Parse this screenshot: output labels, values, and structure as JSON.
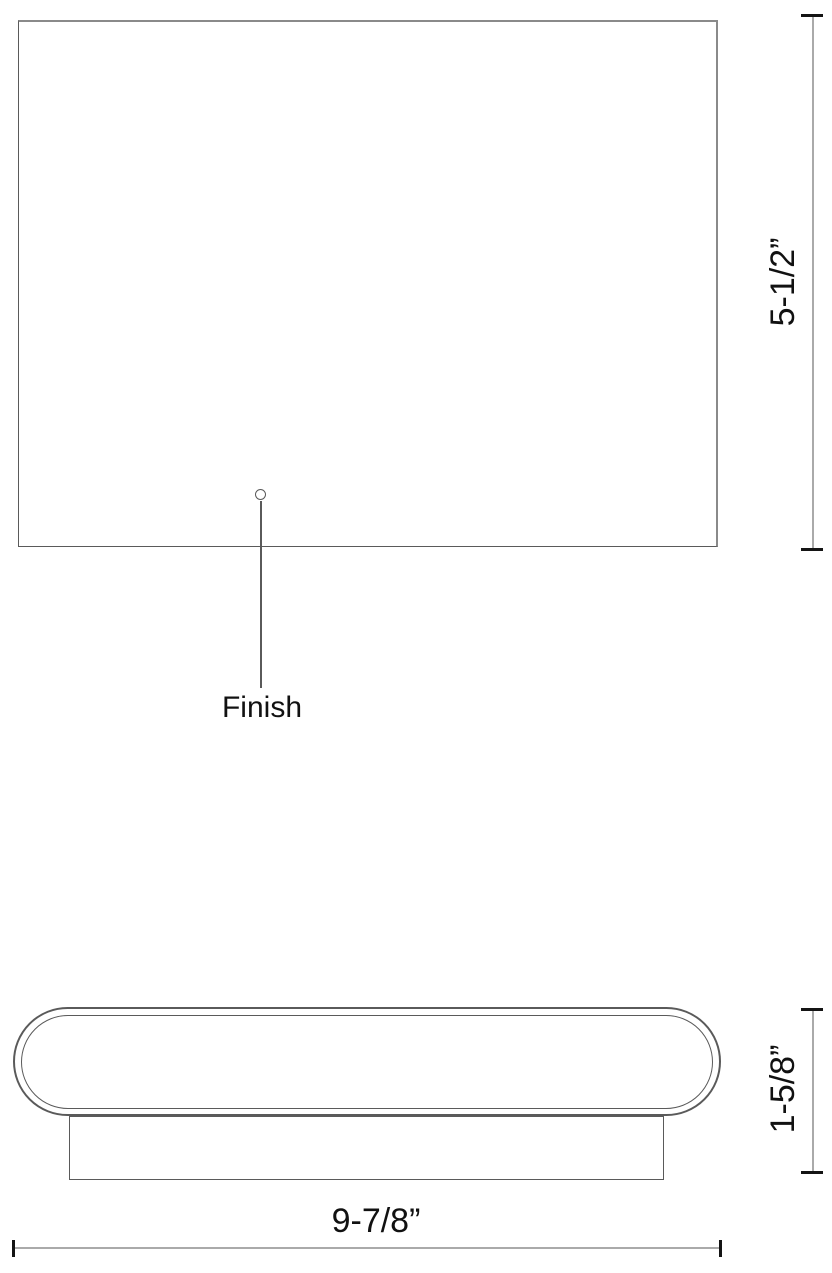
{
  "colors": {
    "background": "#ffffff",
    "outline": "#5a5a5a",
    "outline_soft": "#8a8a8a",
    "dimension_line": "#aaaaaa",
    "tick": "#141414",
    "text": "#111111"
  },
  "front_view": {
    "height_dimension_label": "5-1/2”",
    "finish_callout_label": "Finish"
  },
  "bottom_view": {
    "depth_dimension_label": "1-5/8”",
    "width_dimension_label": "9-7/8”"
  }
}
